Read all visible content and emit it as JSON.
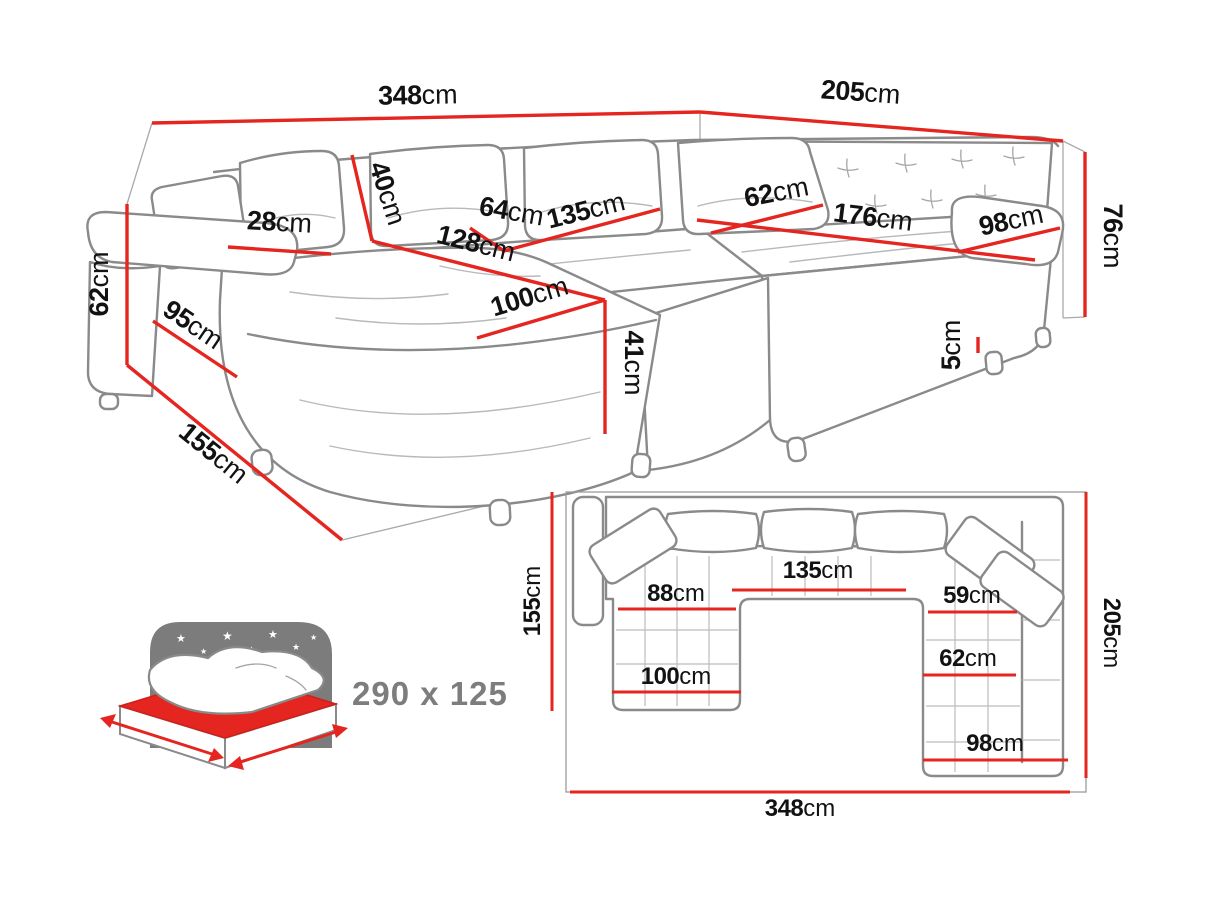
{
  "colors": {
    "dimension_red": "#e5251f",
    "sketch_gray": "#8a8a8a",
    "label_black": "#121212",
    "icon_gray": "#7c7c7c"
  },
  "perspective_view": {
    "dims": {
      "width_main": {
        "v": "348",
        "u": "cm"
      },
      "width_side": {
        "v": "205",
        "u": "cm"
      },
      "height_back_left": {
        "v": "62",
        "u": "cm"
      },
      "backrest_height": {
        "v": "40",
        "u": "cm"
      },
      "armrest_width": {
        "v": "28",
        "u": "cm"
      },
      "chaise_front": {
        "v": "95",
        "u": "cm"
      },
      "side_depth": {
        "v": "155",
        "u": "cm"
      },
      "seat_depth_left": {
        "v": "64",
        "u": "cm"
      },
      "seat_mid_width": {
        "v": "135",
        "u": "cm"
      },
      "seat_len_left": {
        "v": "128",
        "u": "cm"
      },
      "chaise_length": {
        "v": "100",
        "u": "cm"
      },
      "seat_height": {
        "v": "41",
        "u": "cm"
      },
      "seat_depth_right": {
        "v": "62",
        "u": "cm"
      },
      "seat_len_right": {
        "v": "176",
        "u": "cm"
      },
      "arm_seat_right": {
        "v": "98",
        "u": "cm"
      },
      "height_back_right": {
        "v": "76",
        "u": "cm"
      },
      "leg_height": {
        "v": "5",
        "u": "cm"
      }
    }
  },
  "plan_view": {
    "dims": {
      "depth_left": {
        "v": "155",
        "u": "cm"
      },
      "depth_right": {
        "v": "205",
        "u": "cm"
      },
      "width_total": {
        "v": "348",
        "u": "cm"
      },
      "chaise_seat_width": {
        "v": "88",
        "u": "cm"
      },
      "chaise_width": {
        "v": "100",
        "u": "cm"
      },
      "middle_seat_width": {
        "v": "135",
        "u": "cm"
      },
      "right_seat_depth_upper": {
        "v": "59",
        "u": "cm"
      },
      "right_seat_depth_lower": {
        "v": "62",
        "u": "cm"
      },
      "right_seat_width": {
        "v": "98",
        "u": "cm"
      }
    }
  },
  "sleeping_function": {
    "size_label": "290 x 125"
  }
}
